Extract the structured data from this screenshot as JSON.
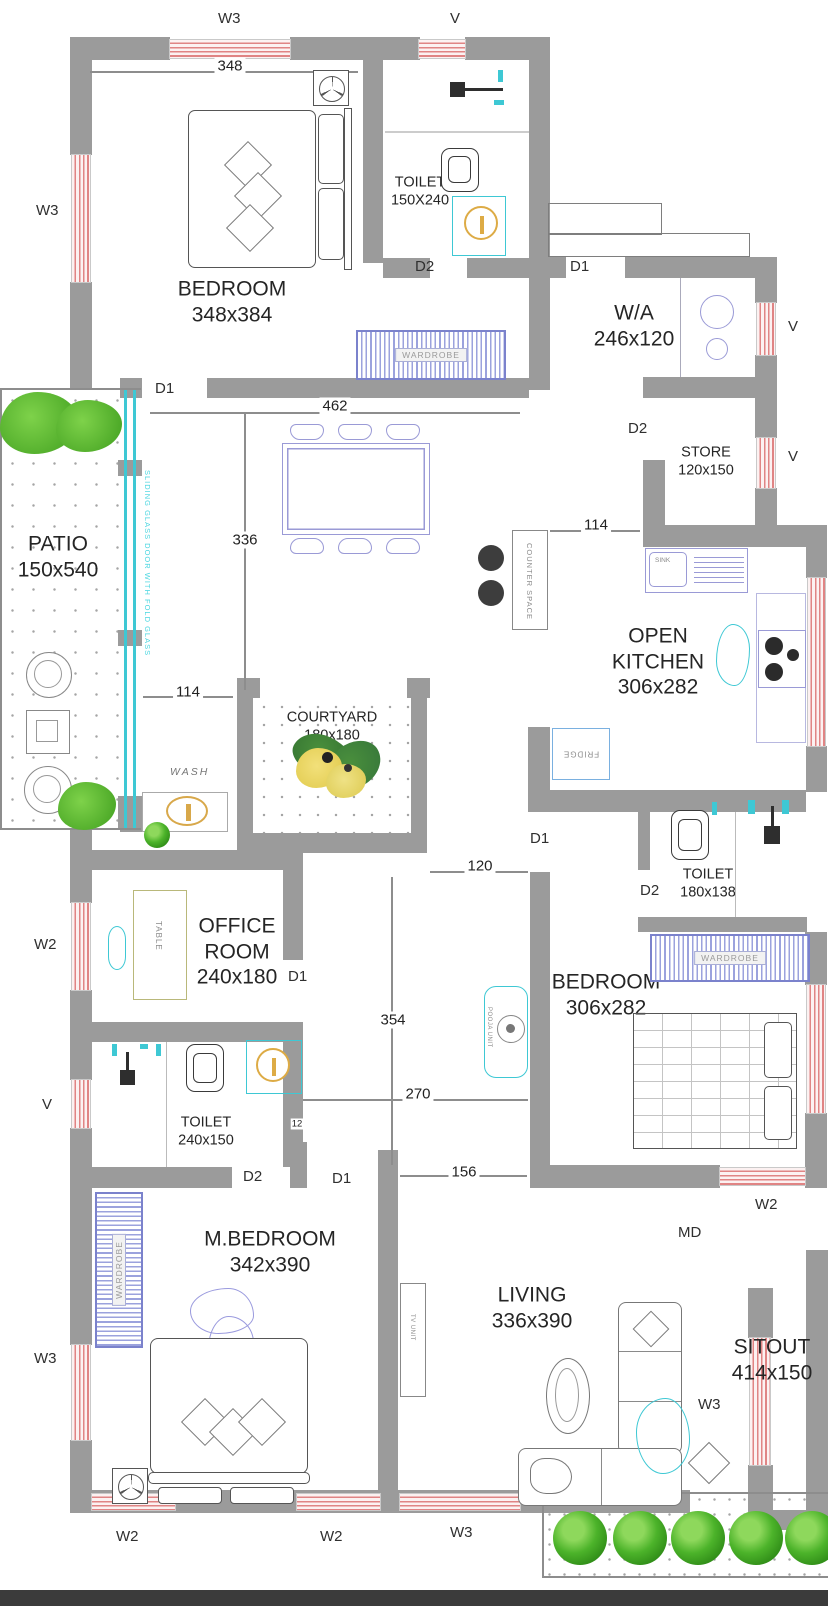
{
  "labels": {
    "w3": "W3",
    "w2": "W2",
    "v": "V",
    "d1": "D1",
    "d2": "D2",
    "md": "MD"
  },
  "rooms": {
    "bedroom1": {
      "name": "BEDROOM",
      "dims": "348x384"
    },
    "toilet1": {
      "name": "TOILET",
      "dims": "150X240"
    },
    "wa": {
      "name": "W/A",
      "dims": "246x120"
    },
    "store": {
      "name": "STORE",
      "dims": "120x150"
    },
    "dining": {
      "name": "DINING",
      "dims": "462x336"
    },
    "patio": {
      "name": "PATIO",
      "dims": "150x540"
    },
    "courtyard": {
      "name": "COURTYARD",
      "dims": "180x180"
    },
    "kitchen": {
      "name": "OPEN KITCHEN",
      "dims": "306x282"
    },
    "office": {
      "name": "OFFICE ROOM",
      "dims": "240x180"
    },
    "toilet2": {
      "name": "TOILET",
      "dims": "240x150"
    },
    "toilet3": {
      "name": "TOILET",
      "dims": "180x138"
    },
    "bedroom2": {
      "name": "BEDROOM",
      "dims": "306x282"
    },
    "mbedroom": {
      "name": "M.BEDROOM",
      "dims": "342x390"
    },
    "living": {
      "name": "LIVING",
      "dims": "336x390"
    },
    "sitout": {
      "name": "SITOUT",
      "dims": "414x150"
    }
  },
  "dimensions": {
    "bedroom_width": "348",
    "dining_width": "462",
    "dining_depth": "336",
    "patio_passage": "114",
    "kitchen_passage": "114",
    "hall_width": "120",
    "hall_depth": "354",
    "hall_lower_width": "270",
    "wall_thickness": "12",
    "entry_width": "156"
  },
  "furniture": {
    "wardrobe": "WARDROBE",
    "table": "TABLE",
    "sink": "SINK",
    "fridge": "FRIDGE",
    "counter_space": "COUNTER SPACE",
    "pooja_unit": "POOJA UNIT",
    "tv_unit": "TV UNIT",
    "wash": "WASH",
    "sliding_door": "SLIDING GLASS DOOR WITH FOLD GLASS"
  },
  "colors": {
    "wall": "#9b9b9b",
    "window_line": "#e08484",
    "wardrobe": "#7b82cc",
    "fixture_cyan": "#3ec8d4",
    "accent_yellow": "#ddab45",
    "plant_green": "#4cb32a",
    "furniture_purple": "#9a9ad6"
  }
}
